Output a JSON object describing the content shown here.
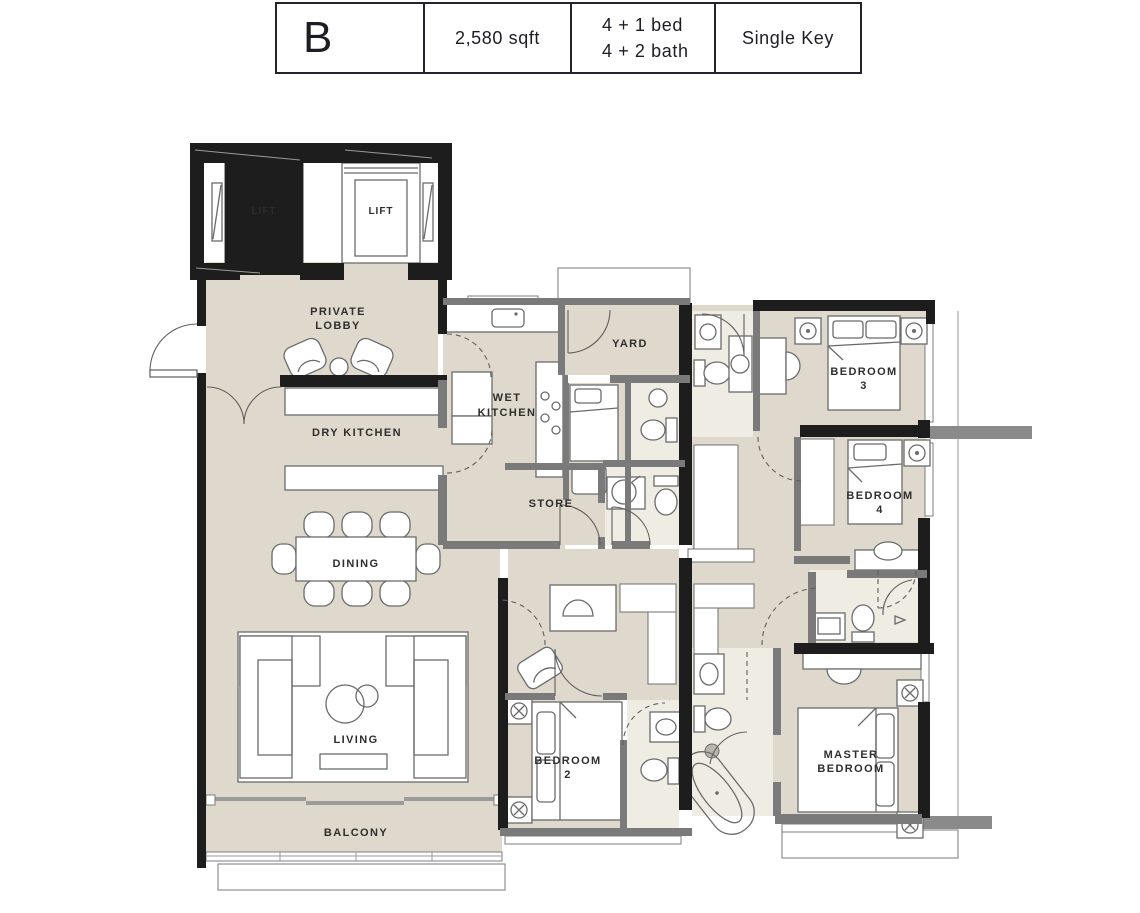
{
  "header": {
    "unit": "B",
    "area": "2,580 sqft",
    "bed_line1": "4 + 1 bed",
    "bed_line2": "4 + 2 bath",
    "key": "Single Key"
  },
  "labels": {
    "lift": "LIFT",
    "private_lobby": [
      "PRIVATE",
      "LOBBY"
    ],
    "dry_kitchen": "DRY KITCHEN",
    "wet_kitchen": [
      "WET",
      "KITCHEN"
    ],
    "yard": "YARD",
    "store": "STORE",
    "dining": "DINING",
    "living": "LIVING",
    "balcony": "BALCONY",
    "bedroom3": [
      "BEDROOM",
      "3"
    ],
    "bedroom4": [
      "BEDROOM",
      "4"
    ],
    "bedroom2": [
      "BEDROOM",
      "2"
    ],
    "master_bedroom": [
      "MASTER",
      "BEDROOM"
    ]
  },
  "colors": {
    "floor": "#ded9cc",
    "bath_floor": "#efece4",
    "wall_black": "#1d1d1d",
    "wall_gray": "#7a7a7a",
    "table_border": "#23232b"
  }
}
